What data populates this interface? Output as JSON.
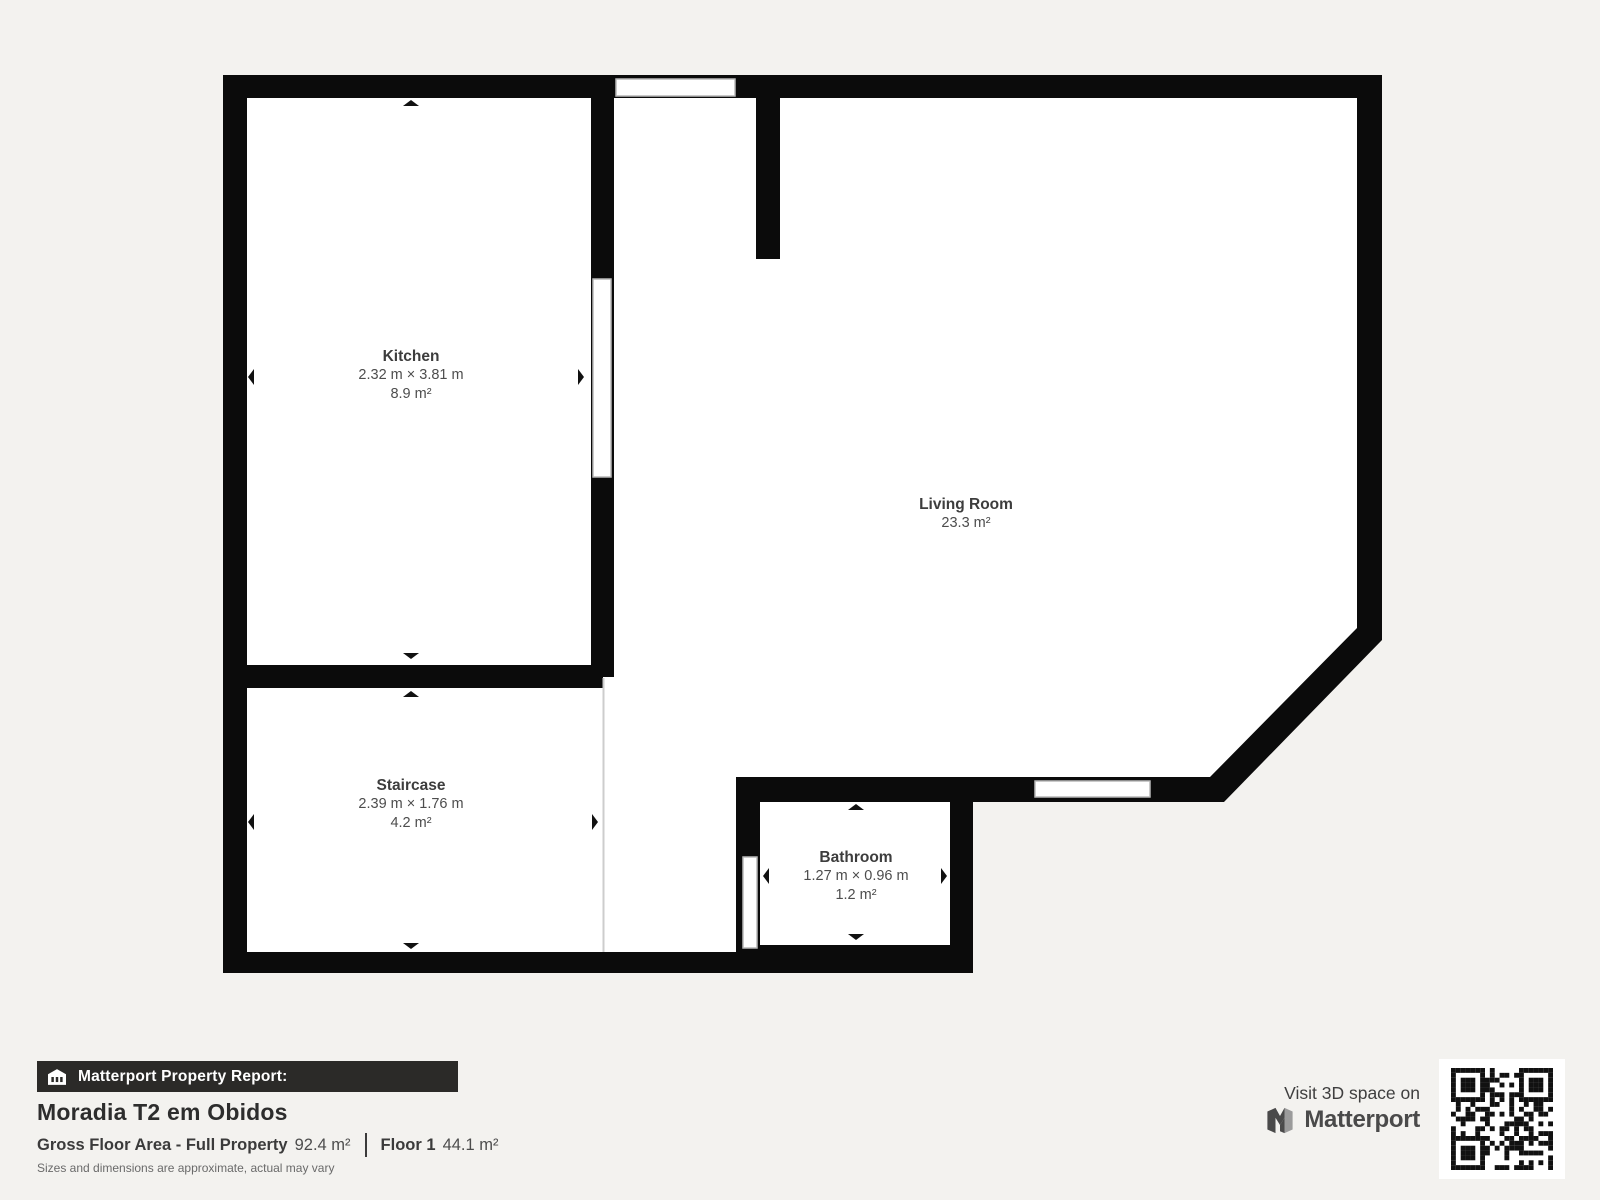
{
  "page": {
    "background": "#f3f2ef"
  },
  "floorplan": {
    "wall_color": "#0b0b0b",
    "room_fill": "#ffffff",
    "rooms": {
      "kitchen": {
        "name": "Kitchen",
        "dims": "2.32 m × 3.81 m",
        "area": "8.9 m²"
      },
      "living": {
        "name": "Living Room",
        "area": "23.3 m²"
      },
      "staircase": {
        "name": "Staircase",
        "dims": "2.39 m × 1.76 m",
        "area": "4.2 m²"
      },
      "bathroom": {
        "name": "Bathroom",
        "dims": "1.27 m × 0.96 m",
        "area": "1.2 m²"
      }
    }
  },
  "footer": {
    "report_label": "Matterport Property Report:",
    "property_name": "Moradia T2 em Obidos",
    "gross_area_label": "Gross Floor Area - Full Property",
    "gross_area_value": "92.4 m²",
    "floor_label": "Floor 1",
    "floor_value": "44.1 m²",
    "disclaimer": "Sizes and dimensions are approximate, actual may vary",
    "visit_text": "Visit 3D space on",
    "brand_name": "Matterport"
  }
}
